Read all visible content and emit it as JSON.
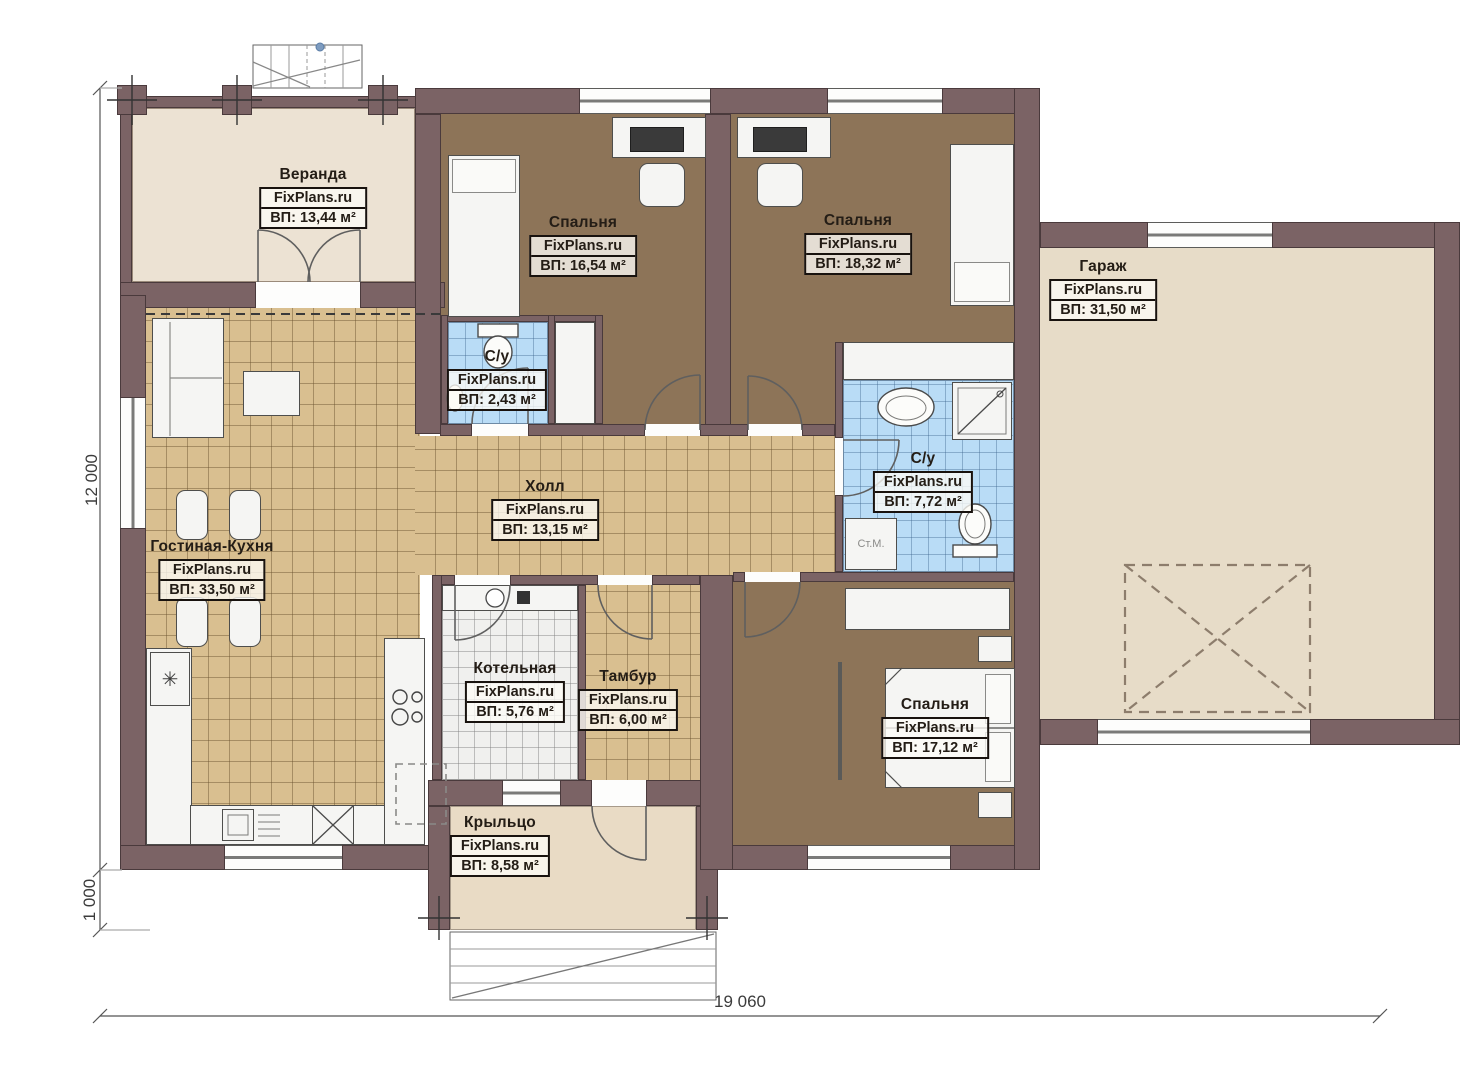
{
  "title": "План этажа (одноэтажный дом с гаражом)",
  "watermark": "FixPlans.ru",
  "rooms": [
    {
      "key": "veranda",
      "name": "Веранда",
      "watermark": "FixPlans.ru",
      "area": "ВП: 13,44 м²"
    },
    {
      "key": "bedroom-1",
      "name": "Спальня",
      "watermark": "FixPlans.ru",
      "area": "ВП: 16,54 м²"
    },
    {
      "key": "bedroom-2",
      "name": "Спальня",
      "watermark": "FixPlans.ru",
      "area": "ВП: 18,32 м²"
    },
    {
      "key": "garage",
      "name": "Гараж",
      "watermark": "FixPlans.ru",
      "area": "ВП: 31,50 м²"
    },
    {
      "key": "bath-small",
      "name": "С/у",
      "watermark": "FixPlans.ru",
      "area": "ВП: 2,43 м²"
    },
    {
      "key": "bath-big",
      "name": "С/у",
      "watermark": "FixPlans.ru",
      "area": "ВП: 7,72 м²"
    },
    {
      "key": "hall",
      "name": "Холл",
      "watermark": "FixPlans.ru",
      "area": "ВП: 13,15 м²"
    },
    {
      "key": "living-kitchen",
      "name": "Гостиная-Кухня",
      "watermark": "FixPlans.ru",
      "area": "ВП: 33,50 м²"
    },
    {
      "key": "boiler",
      "name": "Котельная",
      "watermark": "FixPlans.ru",
      "area": "ВП: 5,76 м²"
    },
    {
      "key": "tambour",
      "name": "Тамбур",
      "watermark": "FixPlans.ru",
      "area": "ВП: 6,00 м²"
    },
    {
      "key": "bedroom-3",
      "name": "Спальня",
      "watermark": "FixPlans.ru",
      "area": "ВП: 17,12 м²"
    },
    {
      "key": "porch",
      "name": "Крыльцо",
      "watermark": "FixPlans.ru",
      "area": "ВП: 8,58 м²"
    }
  ],
  "labels": {
    "washing_machine": "Ст.М."
  },
  "icons": {
    "fridge": "✳"
  },
  "dimensions": {
    "height_main": "12 000",
    "height_porch": "1 000",
    "width_total": "19 060"
  },
  "colors": {
    "wall": "#7b6365",
    "floor_tile_tan": "#d9bf90",
    "floor_bedroom": "#8d7458",
    "floor_bath": "#b9dcf6",
    "floor_veranda": "#ece2d3",
    "floor_garage": "#e7dcc8",
    "floor_boiler": "#f0f0ee",
    "floor_porch": "#e9dbc5"
  }
}
